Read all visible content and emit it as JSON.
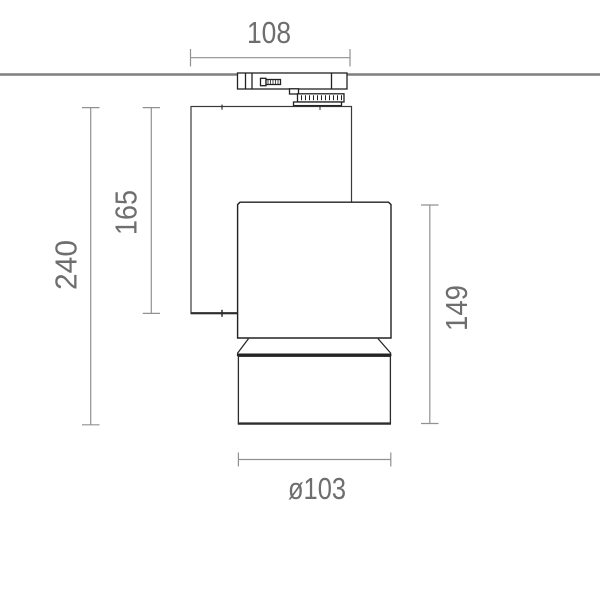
{
  "drawing": {
    "labels": {
      "width_top": "108",
      "height_overall": "240",
      "height_body": "165",
      "height_head": "149",
      "diameter_front": "ø103"
    },
    "colors": {
      "background": "#ffffff",
      "outline": "#2d2d2d",
      "ceiling_line": "#7f7f7f",
      "dimension_line": "#919191",
      "dimension_text": "#6e6e6e"
    }
  }
}
